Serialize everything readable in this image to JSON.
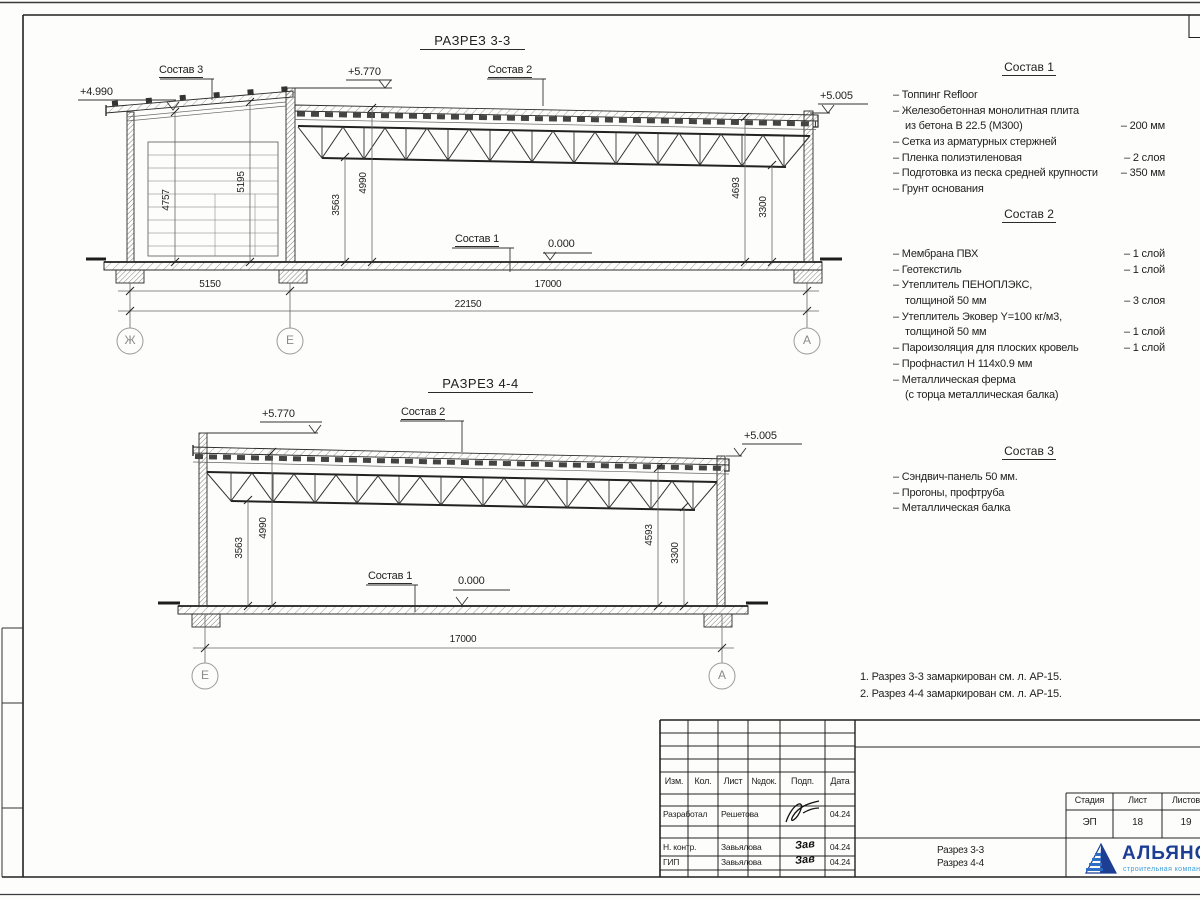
{
  "section33": {
    "title": "РАЗРЕЗ 3-3",
    "label_sostav3": "Состав 3",
    "label_sostav2": "Состав 2",
    "label_sostav1": "Состав 1",
    "level_left": "+4.990",
    "level_top": "+5.770",
    "level_right": "+5.005",
    "level_zero": "0.000",
    "dim_4757": "4757",
    "dim_5195": "5195",
    "dim_3563": "3563",
    "dim_4990": "4990",
    "dim_4693": "4693",
    "dim_3300": "3300",
    "dim_5150": "5150",
    "dim_17000": "17000",
    "dim_22150": "22150",
    "axis_zh": "Ж",
    "axis_e": "Е",
    "axis_a": "А"
  },
  "section44": {
    "title": "РАЗРЕЗ 4-4",
    "label_sostav2": "Состав 2",
    "label_sostav1": "Состав 1",
    "level_top": "+5.770",
    "level_right": "+5.005",
    "level_zero": "0.000",
    "dim_3563": "3563",
    "dim_4990": "4990",
    "dim_4593": "4593",
    "dim_3300": "3300",
    "dim_17000": "17000",
    "axis_e": "Е",
    "axis_a": "А"
  },
  "sostav1": {
    "title": "Состав 1",
    "items": [
      {
        "text": "– Топпинг Refloor",
        "value": ""
      },
      {
        "text": "– Железобетонная  монолитная плита",
        "value": ""
      },
      {
        "text": "из бетона В 22.5 (М300)",
        "value": "– 200 мм"
      },
      {
        "text": "– Сетка из арматурных стержней",
        "value": ""
      },
      {
        "text": "– Пленка полиэтиленовая",
        "value": "– 2 слоя"
      },
      {
        "text": "– Подготовка из песка средней крупности",
        "value": "– 350 мм"
      },
      {
        "text": "– Грунт основания",
        "value": ""
      }
    ]
  },
  "sostav2": {
    "title": "Состав 2",
    "items": [
      {
        "text": "– Мембрана ПВХ",
        "value": "– 1 слой"
      },
      {
        "text": "– Геотекстиль",
        "value": "– 1 слой"
      },
      {
        "text": "– Утеплитель ПЕНОПЛЭКС,",
        "value": ""
      },
      {
        "text": "толщиной 50 мм",
        "value": "– 3 слоя"
      },
      {
        "text": "– Утеплитель Эковер Y=100 кг/м3,",
        "value": ""
      },
      {
        "text": "толщиной 50 мм",
        "value": "– 1 слой"
      },
      {
        "text": "– Пароизоляция для плоских кровель",
        "value": "– 1 слой"
      },
      {
        "text": "– Профнастил Н 114х0.9 мм",
        "value": ""
      },
      {
        "text": "– Металлическая ферма",
        "value": ""
      },
      {
        "text": "(с торца металлическая балка)",
        "value": ""
      }
    ]
  },
  "sostav3": {
    "title": "Состав 3",
    "items": [
      {
        "text": "– Сэндвич-панель 50 мм.",
        "value": ""
      },
      {
        "text": "– Прогоны, профтруба",
        "value": ""
      },
      {
        "text": "– Металлическая балка",
        "value": ""
      }
    ]
  },
  "notes": {
    "line1": "1. Разрез 3-3 замаркирован см. л. АР-15.",
    "line2": "2. Разрез 4-4 замаркирован см. л. АР-15."
  },
  "titleblock": {
    "col_izm": "Изм.",
    "col_kol": "Кол.",
    "col_list": "Лист",
    "col_ndoc": "№док.",
    "col_podp": "Подп.",
    "col_data": "Дата",
    "row1_role": "Разработал",
    "row1_name": "Решетова",
    "row1_date": "04.24",
    "row2_role": "Н. контр.",
    "row2_name": "Завьялова",
    "row2_sig": "Зав",
    "row2_date": "04.24",
    "row3_role": "ГИП",
    "row3_name": "Завьялова",
    "row3_sig": "Зав",
    "row3_date": "04.24",
    "doc_name_line1": "Разрез 3-3",
    "doc_name_line2": "Разрез 4-4",
    "stage_label": "Стадия",
    "sheet_label": "Лист",
    "sheets_label": "Листов",
    "stage_value": "ЭП",
    "sheet_value": "18",
    "sheets_value": "19"
  },
  "logo": {
    "name": "АЛЬЯНС",
    "tagline": "строительная компания"
  },
  "colors": {
    "logo_blue": "#1c3f94",
    "logo_light_blue": "#3fa0dc"
  }
}
